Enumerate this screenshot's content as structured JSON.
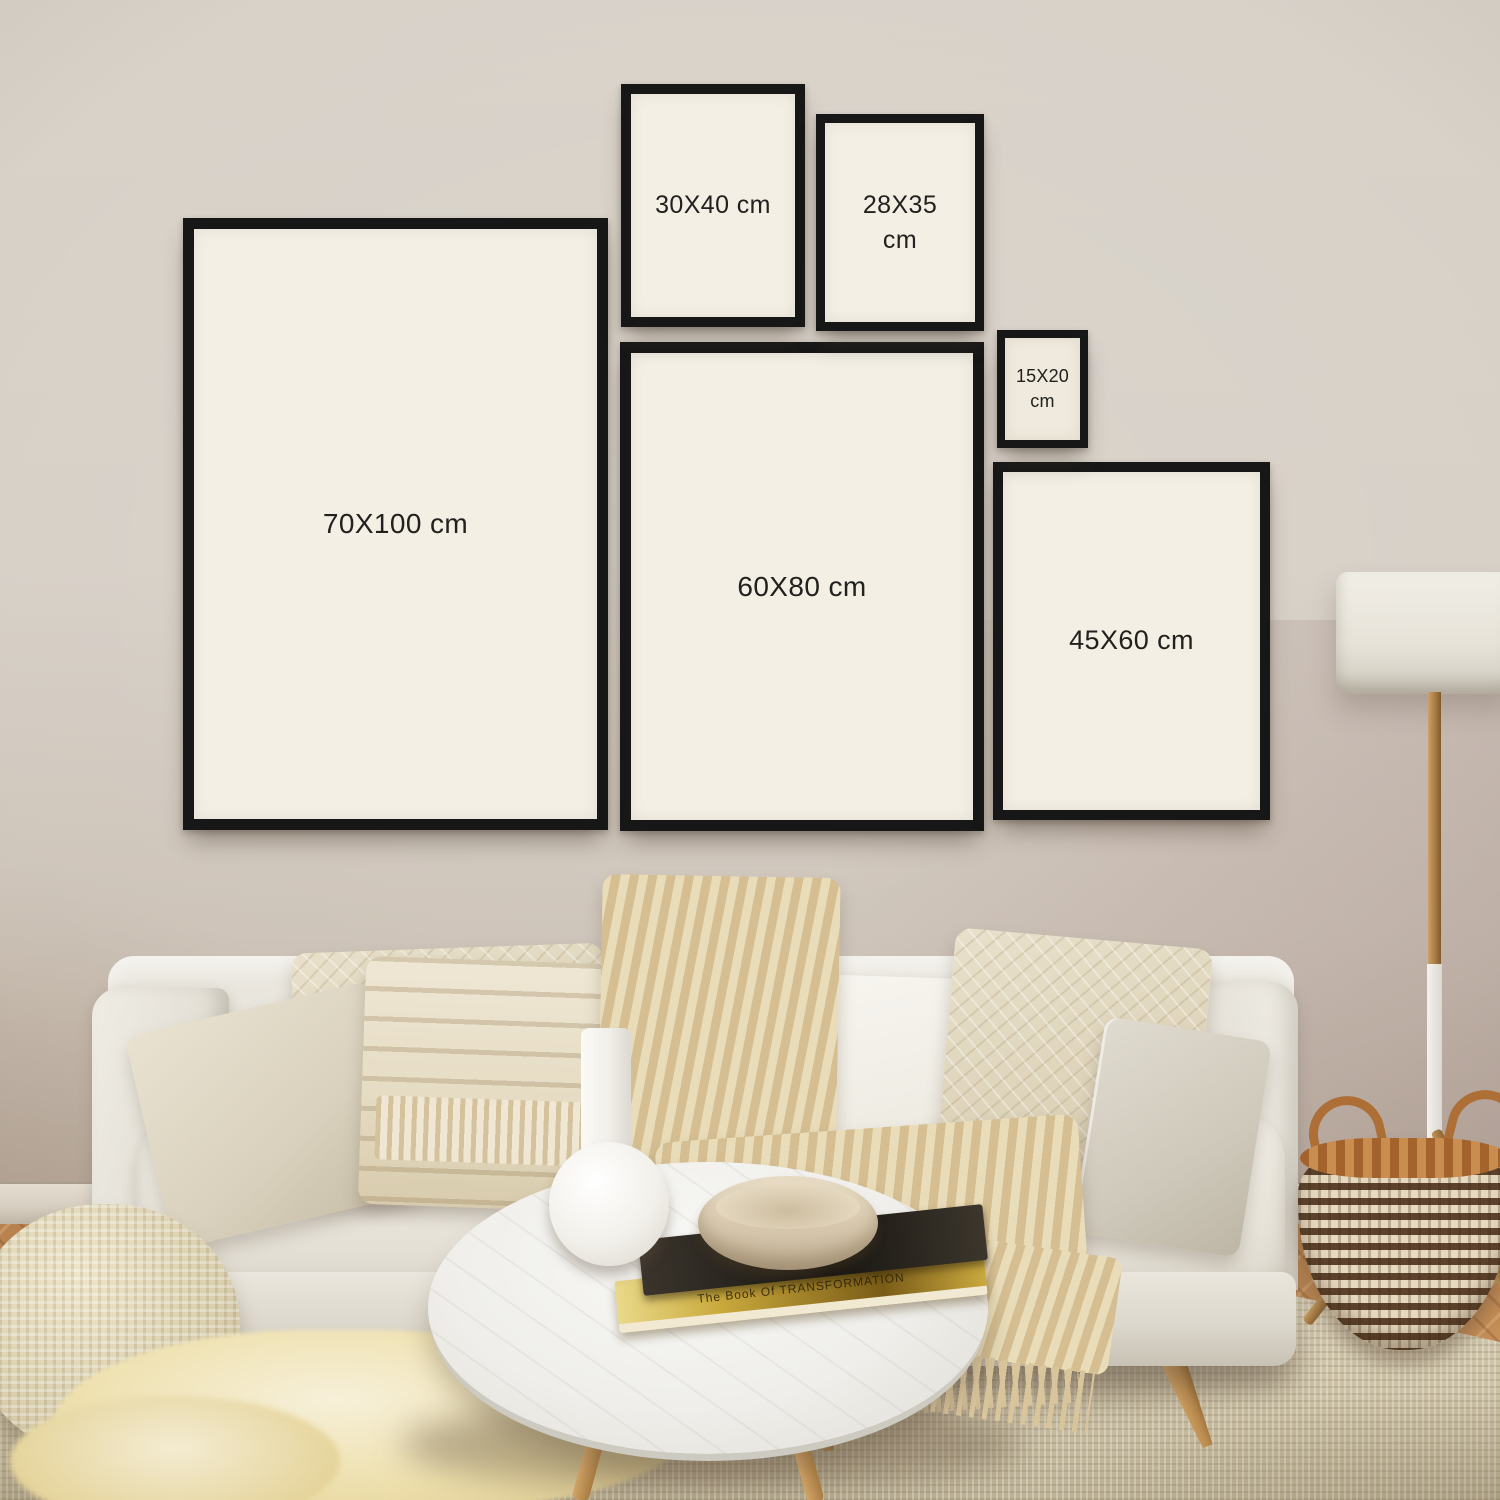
{
  "frames": [
    {
      "name": "frame-70x100",
      "label": "70X100 cm"
    },
    {
      "name": "frame-60x80",
      "label": "60X80 cm"
    },
    {
      "name": "frame-45x60",
      "label": "45X60 cm"
    },
    {
      "name": "frame-30x40",
      "label": "30X40 cm"
    },
    {
      "name": "frame-28x35",
      "label": "28X35 cm"
    },
    {
      "name": "frame-15x20",
      "label": "15X20 cm"
    }
  ],
  "coffee_table_books": {
    "top_book_spine": "NEWTON",
    "bottom_book_spine": "The Book Of TRANSFORMATION"
  },
  "colors": {
    "wall": "#d7d1c8",
    "wall_shadow": "#ab9c92",
    "frame_border": "#171717",
    "frame_mat": "#f3efe5",
    "label_text": "#22211e",
    "sofa_fabric": "#e7e4db",
    "pillow_cream": "#e5ddcb",
    "throw_knit": "#dcc9a4",
    "rug_jute": "#cfc5aa",
    "floor_wood": "#c28d55",
    "baseboard": "#ddd6c9",
    "basket_dark": "#5d432c",
    "basket_light": "#e9dcc4",
    "basket_rim": "#b5773d",
    "lamp_shade": "#ebe8e0",
    "table_marble": "#f2f2f0",
    "book_yellow": "#c9a93c",
    "book_dark": "#25211b",
    "vase_white": "#f5f4f0"
  }
}
